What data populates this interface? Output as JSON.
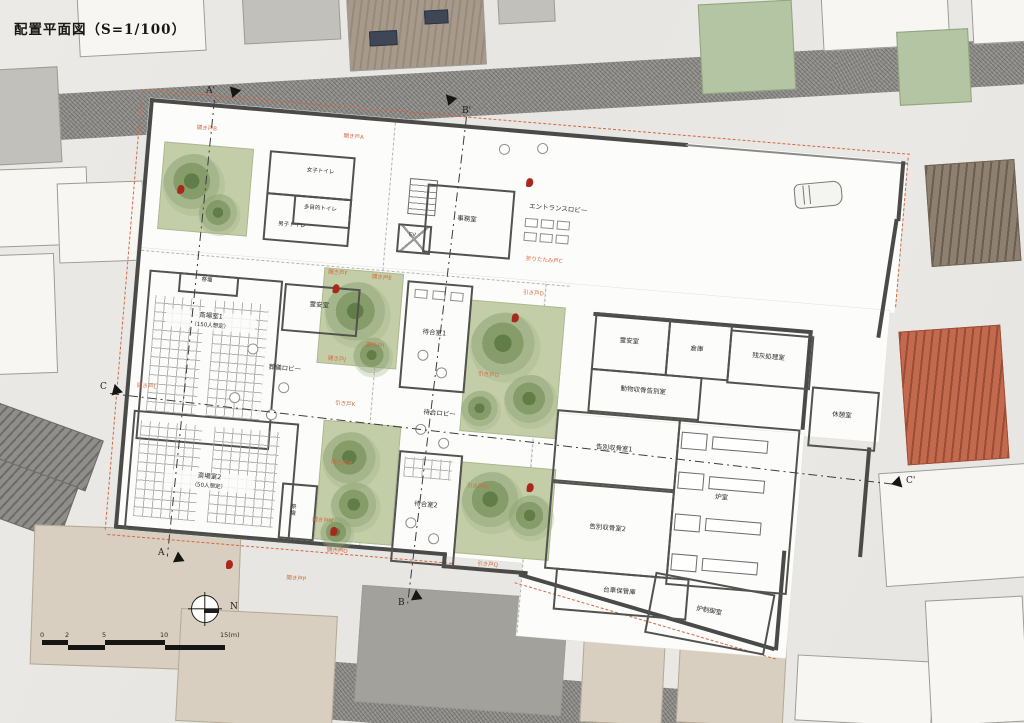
{
  "title": "配置平面図（S=1/100）",
  "palette": {
    "door-orange": "#d4683f",
    "wall": "#4a4a48",
    "garden": "#c3cda7",
    "red-accent": "#a8291c",
    "road": "#8f8e8b",
    "beige": "#d9cfc0",
    "green-bldg": "#b3c5a2",
    "terracotta": "#c2694e"
  },
  "compass": {
    "north": "N"
  },
  "scale_bar": {
    "ticks": [
      "0",
      "2",
      "5",
      "10",
      "15(m)"
    ]
  },
  "sections": {
    "a_top": "A'",
    "b_top": "B'",
    "a_bottom": "A",
    "b_bottom": "B",
    "c_left": "C",
    "c_right": "C'"
  },
  "rooms": {
    "women_toilet": "女子トイレ",
    "multi_toilet": "多目的トイレ",
    "men_toilet": "男子トイレ",
    "elevator": "EV",
    "office": "事務室",
    "entrance_lobby": "エントランスロビー",
    "altar1": "祭壇",
    "mortuary1": "霊安室",
    "hall1_name": "斎場室1",
    "hall1_capacity": "（150人想定）",
    "funeral_lobby": "葬儀ロビー",
    "waiting1": "待合室1",
    "waiting_lobby": "待合ロビー",
    "waiting2": "待合室2",
    "hall2_name": "斎場室2",
    "hall2_capacity": "（50人想定）",
    "altar2": "祭壇",
    "mortuary2": "霊安室",
    "storage": "倉庫",
    "ash_processing": "残灰処理室",
    "animal_farewell": "動物収骨告別室",
    "break_room": "休憩室",
    "farewell1": "告別収骨室1",
    "furnace_room": "炉室",
    "farewell2": "告別収骨室2",
    "cart_storage": "台車保管庫",
    "furnace_control": "炉制御室"
  },
  "doors": {
    "a": "開き戸A",
    "b": "開き戸B",
    "c": "折りたたみ戸C",
    "d": "引き戸D",
    "e": "開き戸E",
    "f": "開き戸F",
    "g": "引き戸G",
    "h": "引き戸H",
    "i": "開き戸I",
    "j": "開き戸J",
    "k": "引き戸K",
    "l": "開き戸L",
    "m": "開き戸M",
    "n": "開き戸N",
    "o": "開き戸O",
    "p": "開き戸P",
    "q": "引き戸Q"
  }
}
